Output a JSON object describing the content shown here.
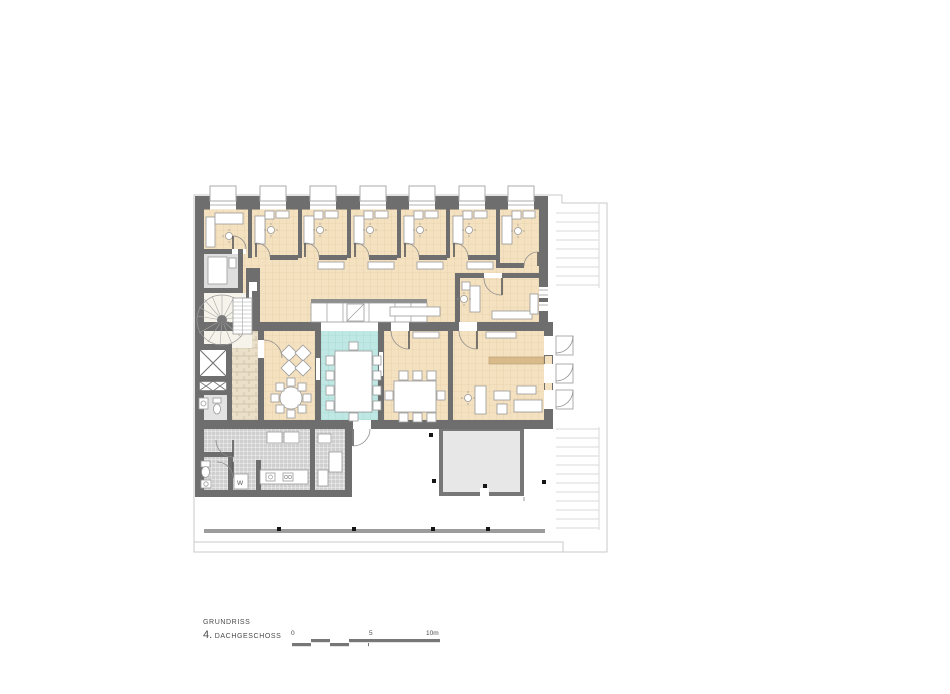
{
  "title_block": {
    "line1": "GRUNDRISS",
    "floor_number": "4.",
    "floor_name": "DACHGESCHOSS"
  },
  "scale_bar": {
    "zero": "0",
    "five": "5",
    "ten": "10m"
  },
  "labels": {
    "washer": "W"
  },
  "colors": {
    "wall": "#6e6e6e",
    "wallLight": "#8f8f8f",
    "wood": "#f4e1bf",
    "woodLine": "#e2c9a2",
    "cyan": "#bfe8e4",
    "cyanLine": "#9ad2cc",
    "grayFloor": "#cfcfcf",
    "grayRoom": "#dedede",
    "stone": "#eadfc9",
    "stoneLine": "#c9bca0",
    "outline": "#c9c9c9",
    "hatch": "#dadada",
    "furn": "#9a9a9a",
    "sideboard": "#d9ba8b",
    "rail": "#9c9c9c",
    "roofBox": "#e7e7e7",
    "roofBoxBorder": "#777777",
    "text": "#4a4a4a",
    "scalebar": "#777777"
  }
}
